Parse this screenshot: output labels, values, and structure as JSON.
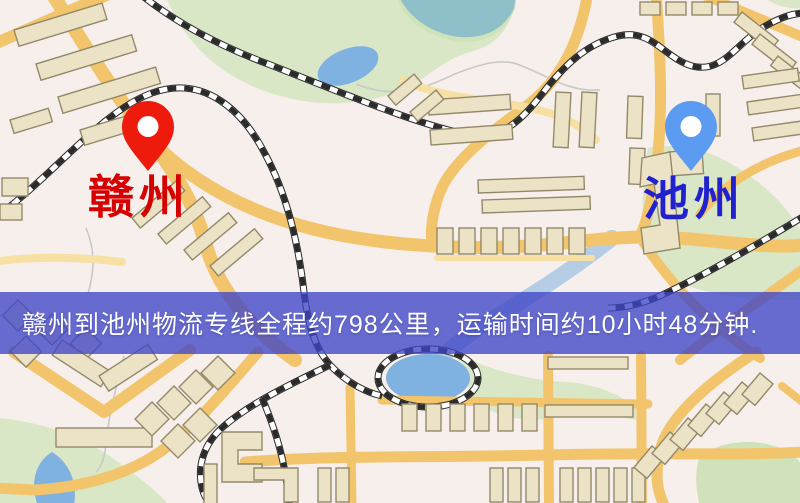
{
  "map": {
    "origin": {
      "label": "赣州"
    },
    "destination": {
      "label": "池州"
    }
  },
  "banner": {
    "text": "赣州到池州物流专线全程约798公里，运输时间约10小时48分钟.",
    "distance_km": 798,
    "duration_text": "10小时48分钟"
  },
  "palette": {
    "map-bg": "#f6efec",
    "park": "#d9e7c7",
    "park-dark": "#cfe2ba",
    "water": "#7fb2e0",
    "water-teal": "#8fc0c9",
    "stream": "#c9c9c9",
    "road": "#f2c56c",
    "road-minor": "#f7e0a4",
    "building": "#ece3c6",
    "building-stroke": "#93896a",
    "railway": "#2b2b2b",
    "railway-base": "#ffffff",
    "banner-bg": "rgba(63,69,198,0.78)",
    "banner-text": "#ffffff",
    "origin-label": "#d60000",
    "destination-label": "#2121d0",
    "origin-pin": "#ee1b0c",
    "destination-pin": "#5b9bf2"
  }
}
